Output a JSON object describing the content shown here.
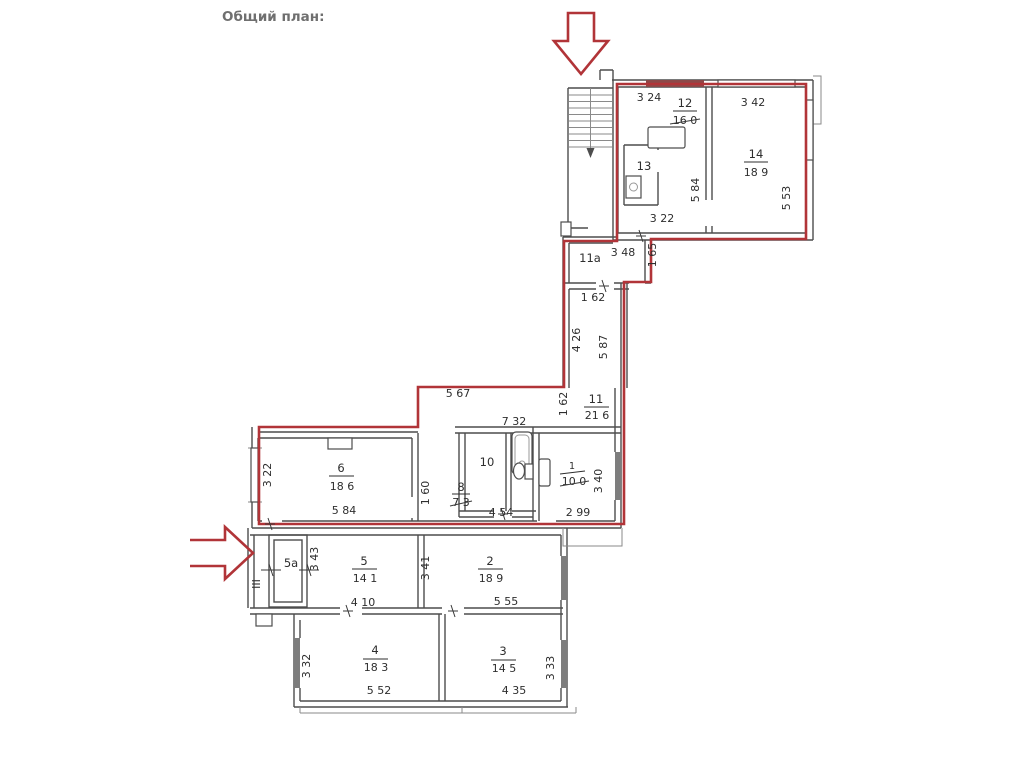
{
  "title": "Общий план:",
  "plan": {
    "accent_color": "#b13438",
    "wall_color": "#4d4d4d",
    "entrance_label": "III",
    "rooms": {
      "r12": {
        "num": "12",
        "area": "16 0"
      },
      "r13": {
        "num": "13"
      },
      "r14": {
        "num": "14",
        "area": "18 9"
      },
      "r11a": {
        "num": "11a"
      },
      "r11": {
        "num": "11",
        "area": "21 6"
      },
      "r10": {
        "num": "10"
      },
      "r6": {
        "num": "6",
        "area": "18 6"
      },
      "r8": {
        "num": "8",
        "area": "7 3"
      },
      "r1": {
        "num": "1",
        "area": "10 0"
      },
      "r5a": {
        "num": "5a"
      },
      "r5": {
        "num": "5",
        "area": "14 1"
      },
      "r2": {
        "num": "2",
        "area": "18 9"
      },
      "r4": {
        "num": "4",
        "area": "18 3"
      },
      "r3": {
        "num": "3",
        "area": "14 5"
      }
    },
    "dims": {
      "r12_w": "3 24",
      "r14_w": "3 42",
      "r12_h": "5 84",
      "r14_h": "5 53",
      "r13_b": "3 22",
      "r11a_w": "3 48",
      "r11a_h": "1 65",
      "cor_w_top": "1 62",
      "cor_len1": "4 26",
      "cor_len2": "5 87",
      "cor_top": "5 67",
      "cor_w_mid": "1 62",
      "wc_top": "7 32",
      "r6_h": "3 22",
      "r6_w": "5 84",
      "r8_h": "1 60",
      "r8_w": "4 54",
      "r1_w": "2 99",
      "r1_h": "3 40",
      "r5a_h": "3 43",
      "r5_w": "4 10",
      "r5_h": "3 41",
      "r2_w": "5 55",
      "r4_h": "3 32",
      "r4_w": "5 52",
      "r3_w": "4 35",
      "r3_h": "3 33"
    }
  }
}
